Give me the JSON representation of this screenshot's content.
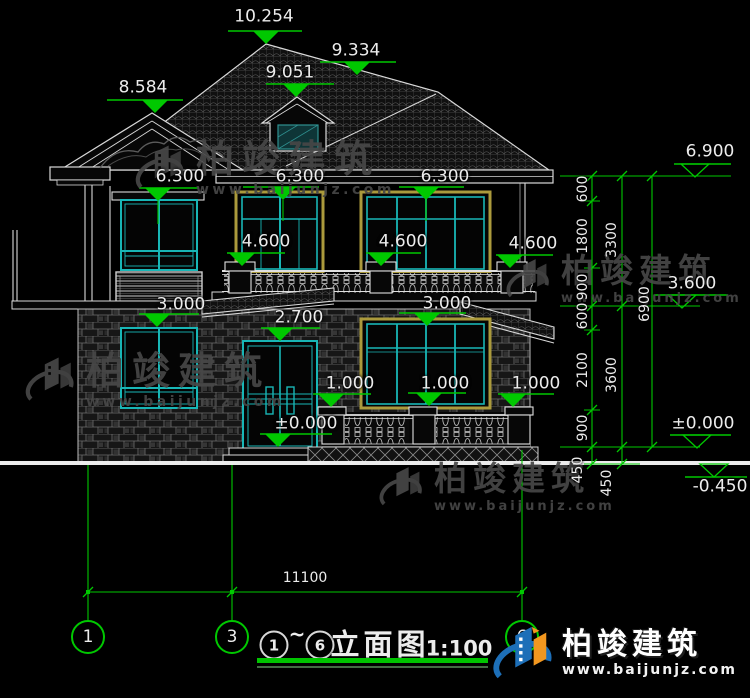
{
  "drawing": {
    "title": {
      "start_bubble": "1",
      "tilde": "~",
      "end_bubble": "6",
      "name": "立面图",
      "scale": "1:100"
    },
    "grid_bubbles": [
      "1",
      "3",
      "6"
    ],
    "bottom_dimension": "11100",
    "elevations": {
      "roof_peak": "10.254",
      "ridge_right": "9.334",
      "dormer": "9.051",
      "gable_left": "8.584",
      "eave_left": "6.300",
      "eave_mid": "6.300",
      "eave_right": "6.300",
      "balcony_left": "4.600",
      "balcony_mid": "4.600",
      "balcony_right": "4.600",
      "slab_left": "3.000",
      "window_head": "3.000",
      "door_head": "2.700",
      "sill_left": "1.000",
      "sill_mid": "1.000",
      "sill_right": "1.000",
      "ground_door": "±0.000",
      "right_eave": "6.900",
      "right_mid": "3.600",
      "right_zero": "±0.000",
      "right_base": "-0.450"
    },
    "dim_chain_segments": [
      "600",
      "1800",
      "900",
      "600",
      "2100",
      "900",
      "450"
    ],
    "dim_chain_floors": [
      "3300",
      "3600",
      "450"
    ],
    "dim_chain_total": "6900"
  },
  "watermark": {
    "brand": "柏竣建筑",
    "url": "www.baijunjz.com"
  },
  "logo": {
    "brand": "柏竣建筑",
    "url": "www.baijunjz.com"
  }
}
